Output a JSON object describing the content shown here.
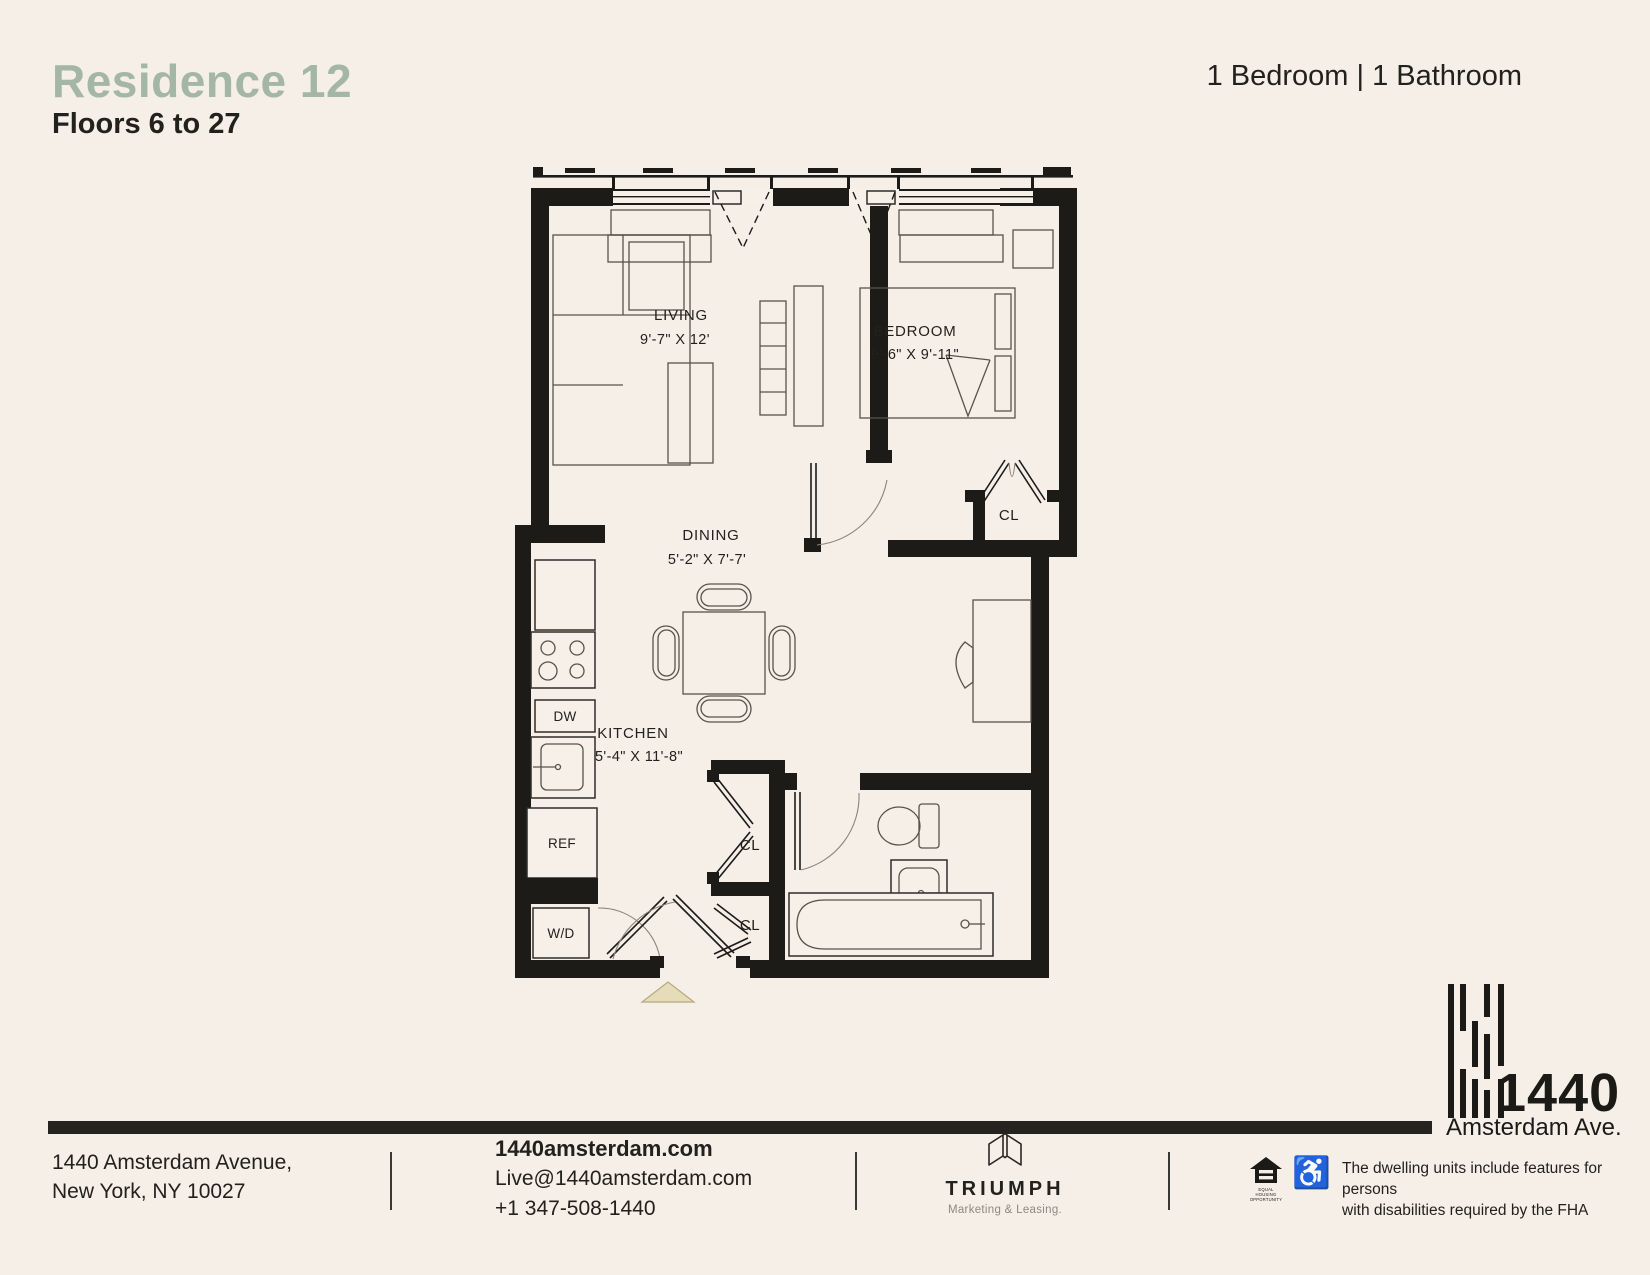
{
  "page": {
    "bg_color": "#f5efe8",
    "accent_green": "#a4b6a5",
    "ink": "#23211c",
    "bar_color": "#262420",
    "arrow_color": "#e7dcba"
  },
  "header": {
    "title": "Residence 12",
    "subtitle": "Floors 6 to 27",
    "unit_info": "1 Bedroom | 1 Bathroom"
  },
  "floor_plan": {
    "rooms": [
      {
        "name": "LIVING",
        "dims": "9'-7\" X 12'"
      },
      {
        "name": "BEDROOM",
        "dims": "9'-6\" X 9'-11\""
      },
      {
        "name": "DINING",
        "dims": "5'-2\" X 7'-7'"
      },
      {
        "name": "KITCHEN",
        "dims": "5'-4\" X 11'-8\""
      }
    ],
    "closet_label": "CL",
    "appliances": {
      "dishwasher": "DW",
      "refrigerator": "REF",
      "washer_dryer": "W/D"
    }
  },
  "logo_1440": {
    "number": "1440",
    "street": "Amsterdam Ave."
  },
  "footer": {
    "address_line1": "1440 Amsterdam Avenue,",
    "address_line2": "New York, NY 10027",
    "website": "1440amsterdam.com",
    "email": "Live@1440amsterdam.com",
    "phone": "+1 347-508-1440",
    "agency_name": "TRIUMPH",
    "agency_tagline": "Marketing & Leasing.",
    "fha_line1": "The dwelling units include features for persons",
    "fha_line2": "with disabilities required by the FHA",
    "equal_housing_caption": "EQUAL HOUSING OPPORTUNITY",
    "wheelchair_icon": "♿"
  }
}
